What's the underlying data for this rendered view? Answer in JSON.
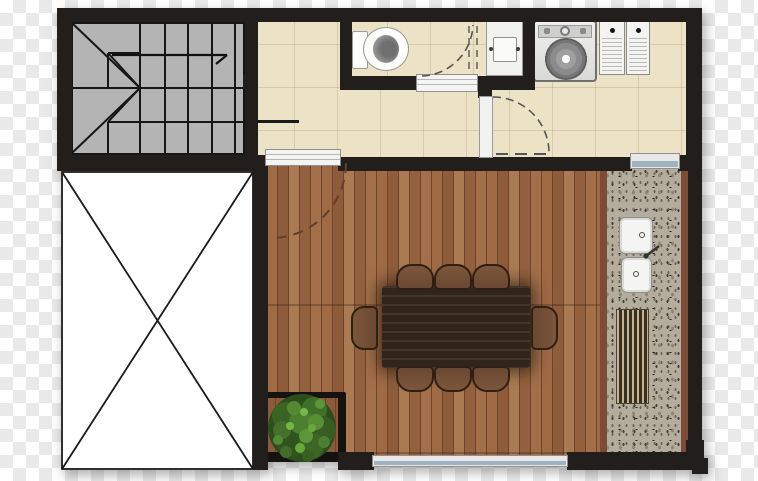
{
  "scene": {
    "type": "architectural-floor-plan",
    "view": "top-down",
    "background": "transparency-checkerboard",
    "visible_text": "none"
  },
  "palette": {
    "wall": "#211e1b",
    "line": "#161616",
    "stair-fill": "#b4b4b4",
    "tile-floor": "#ece2c6",
    "wood-gap": "#6e452c",
    "table-wood": "#31241a",
    "chair-wood": "#6a4832",
    "counter-terrazzo": "#b4ad9d",
    "counter-edge": "#7c4c36",
    "window-glass": "#9fb2c0",
    "fixture-white": "#f2f2f1",
    "planter-black": "#15120f",
    "door-arc": "#555555",
    "deck-door-arc": "#5f4030",
    "checker-a": "#ffffff",
    "checker-b": "#e9e9e9"
  },
  "rooms": [
    {
      "id": "staircase",
      "label": "U-shaped staircase with winders and up-direction arrow",
      "floor": "gray"
    },
    {
      "id": "void",
      "label": "open void / unbuilt area marked with X cross",
      "floor": "none"
    },
    {
      "id": "bathroom",
      "label": "toilet room with in-swing door",
      "floor": "cream-tile"
    },
    {
      "id": "hallway",
      "label": "tiled circulation hall",
      "floor": "cream-tile"
    },
    {
      "id": "laundry",
      "label": "laundry area with washer, tub and louver cabinet",
      "floor": "cream-tile"
    },
    {
      "id": "dining-deck",
      "label": "timber deck dining area with 8-seat table and planter",
      "floor": "wood-planks"
    },
    {
      "id": "kitchen-counter",
      "label": "terrazzo counter with double sink and grill drain",
      "floor": "terrazzo"
    }
  ],
  "fixtures": {
    "toilet": 1,
    "laundry_tub": 1,
    "washing_machine": 1,
    "louver_doors": 2,
    "dining_table": 1,
    "dining_chairs": 8,
    "counter_sinks": 2,
    "grill_drain": 1,
    "planter_with_plant": 1,
    "windows": 2,
    "door_swings": 3,
    "sliding_threshold": 1
  }
}
